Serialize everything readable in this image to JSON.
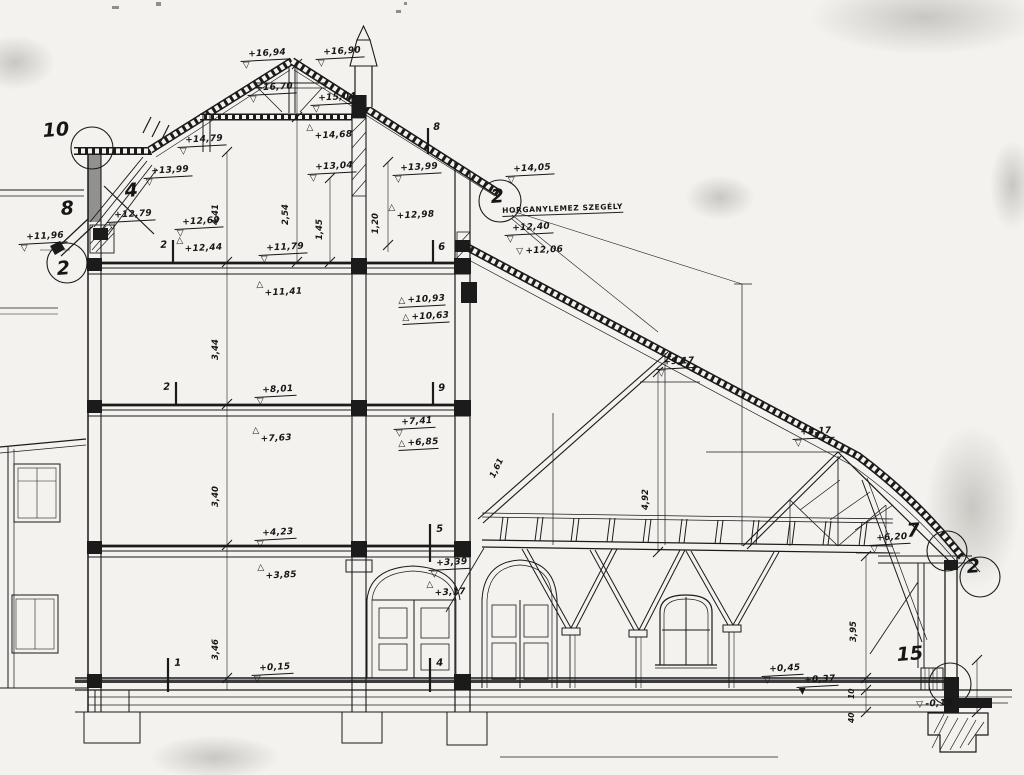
{
  "symbols": {
    "tri_down": "▽",
    "tri_up": "△",
    "tri_solid": "▼"
  },
  "note_label": "HORGANYLEMEZ SZEGÉLY",
  "annotations": [
    {
      "k": "elev",
      "t": "+16,94",
      "x": 240,
      "y": 50
    },
    {
      "k": "elev",
      "t": "+16,90",
      "x": 315,
      "y": 48
    },
    {
      "k": "elev",
      "t": "+16,70",
      "x": 247,
      "y": 84
    },
    {
      "k": "elev",
      "t": "+15,04",
      "x": 310,
      "y": 94
    },
    {
      "k": "elevu",
      "t": "+14,68",
      "x": 306,
      "y": 124
    },
    {
      "k": "elev",
      "t": "+13,04",
      "x": 307,
      "y": 163
    },
    {
      "k": "elev",
      "t": "+14,79",
      "x": 177,
      "y": 136
    },
    {
      "k": "elev",
      "t": "+13,99",
      "x": 143,
      "y": 167
    },
    {
      "k": "elev",
      "t": "+12,79",
      "x": 106,
      "y": 211
    },
    {
      "k": "elev",
      "t": "+12,69",
      "x": 174,
      "y": 218
    },
    {
      "k": "elevu",
      "t": "+12,44",
      "x": 176,
      "y": 237
    },
    {
      "k": "elev",
      "t": "+11,96",
      "x": 18,
      "y": 233
    },
    {
      "k": "elev",
      "t": "+13,99",
      "x": 392,
      "y": 164
    },
    {
      "k": "elevu",
      "t": "+12,98",
      "x": 388,
      "y": 204
    },
    {
      "k": "elev",
      "t": "+14,05",
      "x": 505,
      "y": 165
    },
    {
      "k": "elev",
      "t": "+12,40",
      "x": 504,
      "y": 224
    },
    {
      "k": "elevl",
      "t": "+12,06",
      "x": 516,
      "y": 247
    },
    {
      "k": "elev",
      "t": "+11,79",
      "x": 258,
      "y": 244
    },
    {
      "k": "elevu",
      "t": "+11,41",
      "x": 256,
      "y": 281
    },
    {
      "k": "elevul",
      "t": "+10,93",
      "x": 398,
      "y": 296
    },
    {
      "k": "elevul",
      "t": "+10,63",
      "x": 402,
      "y": 313
    },
    {
      "k": "elev",
      "t": "+9,17",
      "x": 655,
      "y": 358
    },
    {
      "k": "elev",
      "t": "+8,17",
      "x": 792,
      "y": 428
    },
    {
      "k": "elev",
      "t": "+8,01",
      "x": 254,
      "y": 386
    },
    {
      "k": "elevu",
      "t": "+7,63",
      "x": 252,
      "y": 427
    },
    {
      "k": "elev",
      "t": "+7,41",
      "x": 393,
      "y": 418
    },
    {
      "k": "elevul",
      "t": "+6,85",
      "x": 398,
      "y": 439
    },
    {
      "k": "elev",
      "t": "+6,20",
      "x": 868,
      "y": 534
    },
    {
      "k": "elev",
      "t": "+4,23",
      "x": 254,
      "y": 529
    },
    {
      "k": "elevu",
      "t": "+3,85",
      "x": 257,
      "y": 564
    },
    {
      "k": "elev",
      "t": "+3,39",
      "x": 428,
      "y": 559
    },
    {
      "k": "elevu",
      "t": "+3,17",
      "x": 426,
      "y": 581
    },
    {
      "k": "elev",
      "t": "+0,45",
      "x": 761,
      "y": 665
    },
    {
      "k": "elevf",
      "t": "+0,37",
      "x": 796,
      "y": 676
    },
    {
      "k": "elev",
      "t": "+0,15",
      "x": 251,
      "y": 664
    },
    {
      "k": "elevl",
      "t": "-0,10",
      "x": 916,
      "y": 700
    },
    {
      "k": "dim",
      "t": "4,41",
      "x": 221,
      "y": 215,
      "rot": -90
    },
    {
      "k": "dim",
      "t": "2,54",
      "x": 291,
      "y": 215,
      "rot": -90
    },
    {
      "k": "dim",
      "t": "1,45",
      "x": 325,
      "y": 230,
      "rot": -90
    },
    {
      "k": "dim",
      "t": "1,20",
      "x": 381,
      "y": 224,
      "rot": -90
    },
    {
      "k": "dim",
      "t": "3,44",
      "x": 221,
      "y": 350,
      "rot": -90
    },
    {
      "k": "dim",
      "t": "3,40",
      "x": 221,
      "y": 497,
      "rot": -90
    },
    {
      "k": "dim",
      "t": "3,46",
      "x": 221,
      "y": 650,
      "rot": -90
    },
    {
      "k": "dim",
      "t": "4,92",
      "x": 651,
      "y": 500,
      "rot": -90
    },
    {
      "k": "dim",
      "t": "1,61",
      "x": 497,
      "y": 470,
      "rot": -64
    },
    {
      "k": "dim",
      "t": "3,95",
      "x": 859,
      "y": 632,
      "rot": -90
    },
    {
      "k": "dims",
      "t": "10",
      "x": 856,
      "y": 690,
      "rot": -90
    },
    {
      "k": "dims",
      "t": "40",
      "x": 856,
      "y": 714,
      "rot": -90
    },
    {
      "k": "big",
      "t": "10",
      "x": 42,
      "y": 120
    },
    {
      "k": "big",
      "t": "8",
      "x": 60,
      "y": 198
    },
    {
      "k": "big",
      "t": "4",
      "x": 124,
      "y": 180
    },
    {
      "k": "big",
      "t": "2",
      "x": 56,
      "y": 258
    },
    {
      "k": "big",
      "t": "2",
      "x": 490,
      "y": 186
    },
    {
      "k": "big",
      "t": "7",
      "x": 906,
      "y": 520
    },
    {
      "k": "big",
      "t": "2",
      "x": 966,
      "y": 556
    },
    {
      "k": "big",
      "t": "15",
      "x": 896,
      "y": 644
    },
    {
      "k": "tick",
      "t": "2",
      "x": 160,
      "y": 240
    },
    {
      "k": "tick",
      "t": "2",
      "x": 163,
      "y": 382
    },
    {
      "k": "tick",
      "t": "9",
      "x": 438,
      "y": 383
    },
    {
      "k": "tick",
      "t": "6",
      "x": 438,
      "y": 242
    },
    {
      "k": "tick",
      "t": "5",
      "x": 436,
      "y": 524
    },
    {
      "k": "tick",
      "t": "1",
      "x": 174,
      "y": 658
    },
    {
      "k": "tick",
      "t": "4",
      "x": 436,
      "y": 658
    },
    {
      "k": "tick",
      "t": "8",
      "x": 433,
      "y": 122
    },
    {
      "k": "note",
      "t": "HORGANYLEMEZ SZEGÉLY",
      "x": 502,
      "y": 206
    }
  ]
}
